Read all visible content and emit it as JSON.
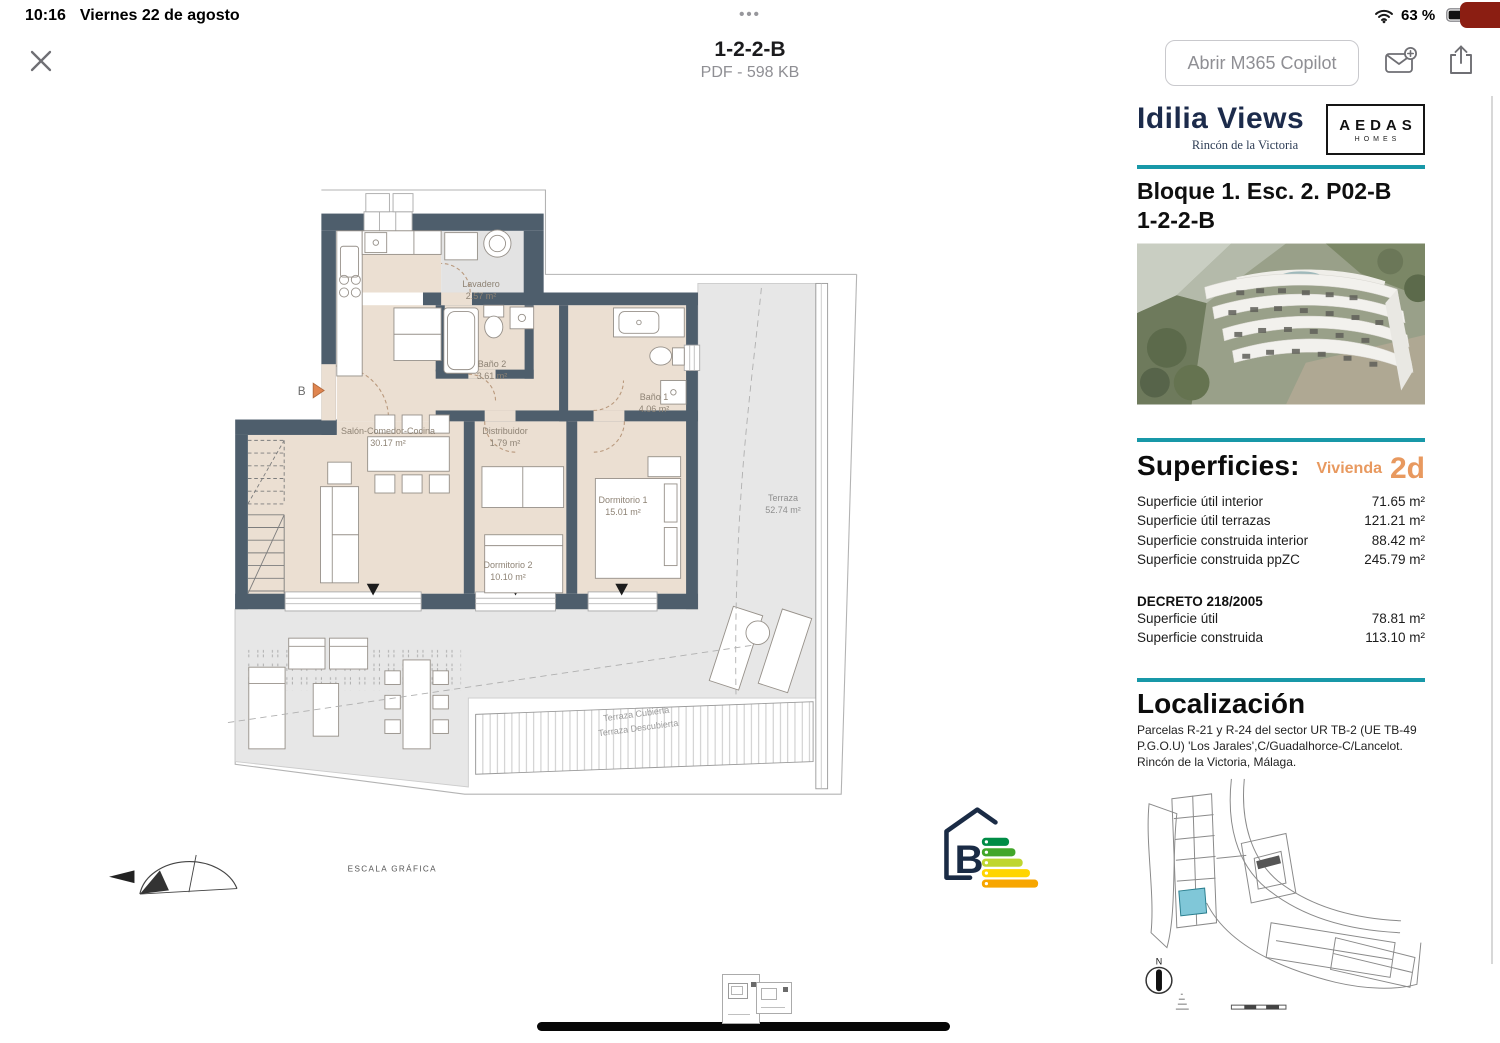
{
  "status_bar": {
    "time": "10:16",
    "date": "Viernes 22 de agosto",
    "more_dots": "•••",
    "battery_percent": "63 %"
  },
  "toolbar": {
    "title": "1-2-2-B",
    "subtitle": "PDF - 598 KB",
    "open_copilot_label": "Abrir M365 Copilot"
  },
  "floor_plan": {
    "rooms": [
      {
        "name": "Lavadero",
        "area": "2.57 m²"
      },
      {
        "name": "Baño 2",
        "area": "3.61 m²"
      },
      {
        "name": "Baño 1",
        "area": "4.06 m²"
      },
      {
        "name": "Salón-Comedor-Cocina",
        "area": "30.17 m²"
      },
      {
        "name": "Distribuidor",
        "area": "1.79 m²"
      },
      {
        "name": "Dormitorio 1",
        "area": "15.01 m²"
      },
      {
        "name": "Dormitorio 2",
        "area": "10.10 m²"
      },
      {
        "name": "Terraza",
        "area": "52.74 m²"
      }
    ],
    "terrace_line_labels": [
      "Terraza Cubierta",
      "Terraza Descubierta"
    ],
    "entry_marker": "B",
    "scale_label": "ESCALA GRÁFICA",
    "energy_rating": "B",
    "north_label": "N"
  },
  "sidebar": {
    "brand": {
      "name": "Idilia Views",
      "location": "Rincón de la Victoria"
    },
    "developer_logo": {
      "line1": "AEDAS",
      "line2": "HOMES"
    },
    "unit_title": {
      "line1": "Bloque 1. Esc. 2. P02-B",
      "line2": "1-2-2-B"
    },
    "superficies": {
      "heading": "Superficies:",
      "dwelling_label": "Vivienda",
      "dwelling_code": "2d",
      "rows": [
        {
          "label": "Superficie útil interior",
          "value": "71.65 m²"
        },
        {
          "label": "Superficie útil terrazas",
          "value": "121.21 m²"
        },
        {
          "label": "Superficie construida interior",
          "value": "88.42 m²"
        },
        {
          "label": "Superficie construida ppZC",
          "value": "245.79 m²"
        }
      ],
      "decreto_heading": "DECRETO 218/2005",
      "decreto_rows": [
        {
          "label": "Superficie útil",
          "value": "78.81 m²"
        },
        {
          "label": "Superficie construida",
          "value": "113.10 m²"
        }
      ]
    },
    "localizacion": {
      "heading": "Localización",
      "description": "Parcelas R-21 y R-24 del sector UR TB-2 (UE TB-49 P.G.O.U) 'Los Jarales',C/Guadalhorce-C/Lancelot. Rincón de la Victoria, Málaga."
    }
  },
  "colors": {
    "teal_rule": "#1898A8",
    "accent_orange": "#E8995F",
    "brand_navy": "#1C2B4B",
    "wall": "#4E5E6C",
    "energy_bars": [
      "#008C46",
      "#42A62A",
      "#BFD630",
      "#FFD500",
      "#F7A600"
    ]
  }
}
